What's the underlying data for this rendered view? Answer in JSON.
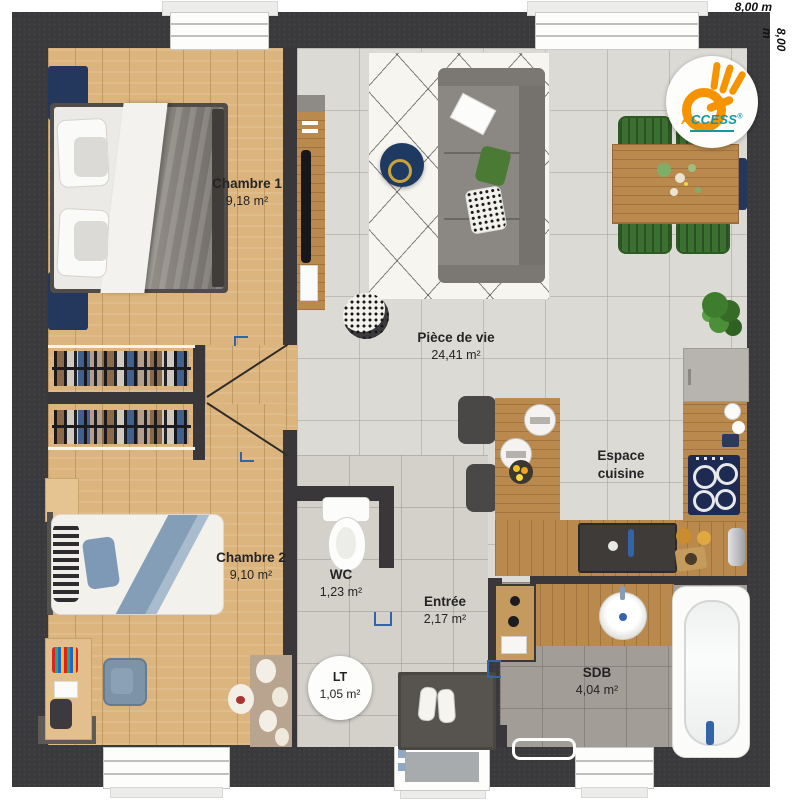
{
  "dimensions": {
    "top": "8,00 m",
    "right": "8,00 m"
  },
  "logo": {
    "brand_first": "A",
    "brand_rest": "CCESS",
    "reg": "®"
  },
  "rooms": {
    "chambre1": {
      "name": "Chambre 1",
      "area": "9,18 m²"
    },
    "chambre2": {
      "name": "Chambre 2",
      "area": "9,10 m²"
    },
    "piece_de_vie": {
      "name": "Pièce de vie",
      "area": "24,41 m²"
    },
    "espace_cuisine": {
      "line1": "Espace",
      "line2": "cuisine"
    },
    "wc": {
      "name": "WC",
      "area": "1,23 m²"
    },
    "entree": {
      "name": "Entrée",
      "area": "2,17 m²"
    },
    "lt": {
      "name": "LT",
      "area": "1,05 m²"
    },
    "sdb": {
      "name": "SDB",
      "area": "4,04 m²"
    }
  },
  "colors": {
    "wall": "#3a393b",
    "wood_floor": "#dcb57e",
    "tile_living": "#dcdad5",
    "tile_sdb": "#a39d97",
    "counter_wood": "#b9894d",
    "accent_blue": "#3464a8",
    "navy_furniture": "#23385c",
    "chair_green": "#3c7031",
    "logo_orange": "#f59300",
    "logo_teal": "#1695a3",
    "label_text": "#242424"
  }
}
